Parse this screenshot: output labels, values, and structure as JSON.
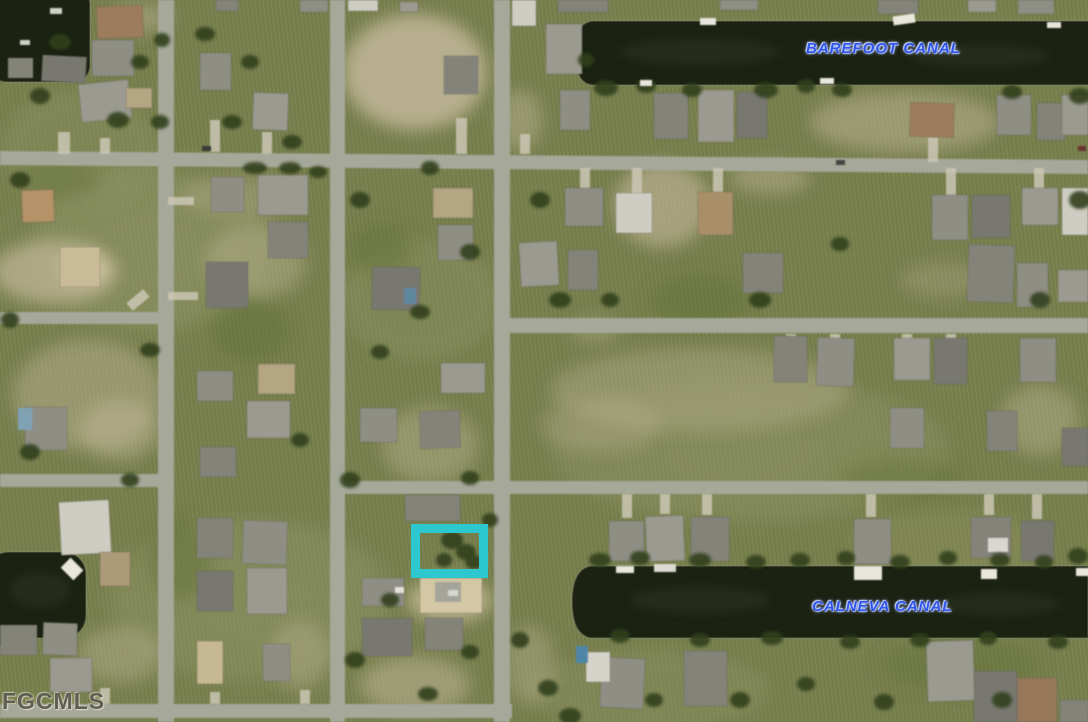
{
  "map": {
    "type": "aerial-satellite-parcel-map",
    "labels": {
      "canal_top": "BAREFOOT CANAL",
      "canal_bottom": "CALNEVA CANAL"
    },
    "watermark": "FGCMLS",
    "highlight": {
      "name": "subject-lot-outline",
      "shape": "rectangle",
      "color": "#2cc7cf"
    },
    "colors": {
      "terrain_green": "#78804d",
      "dirt_tan": "#b9b191",
      "road_gray": "#a6a89a",
      "water_dark": "#1b2212",
      "canal_label_blue": "#2f55e9",
      "watermark_gray": "#4e4c42"
    }
  }
}
